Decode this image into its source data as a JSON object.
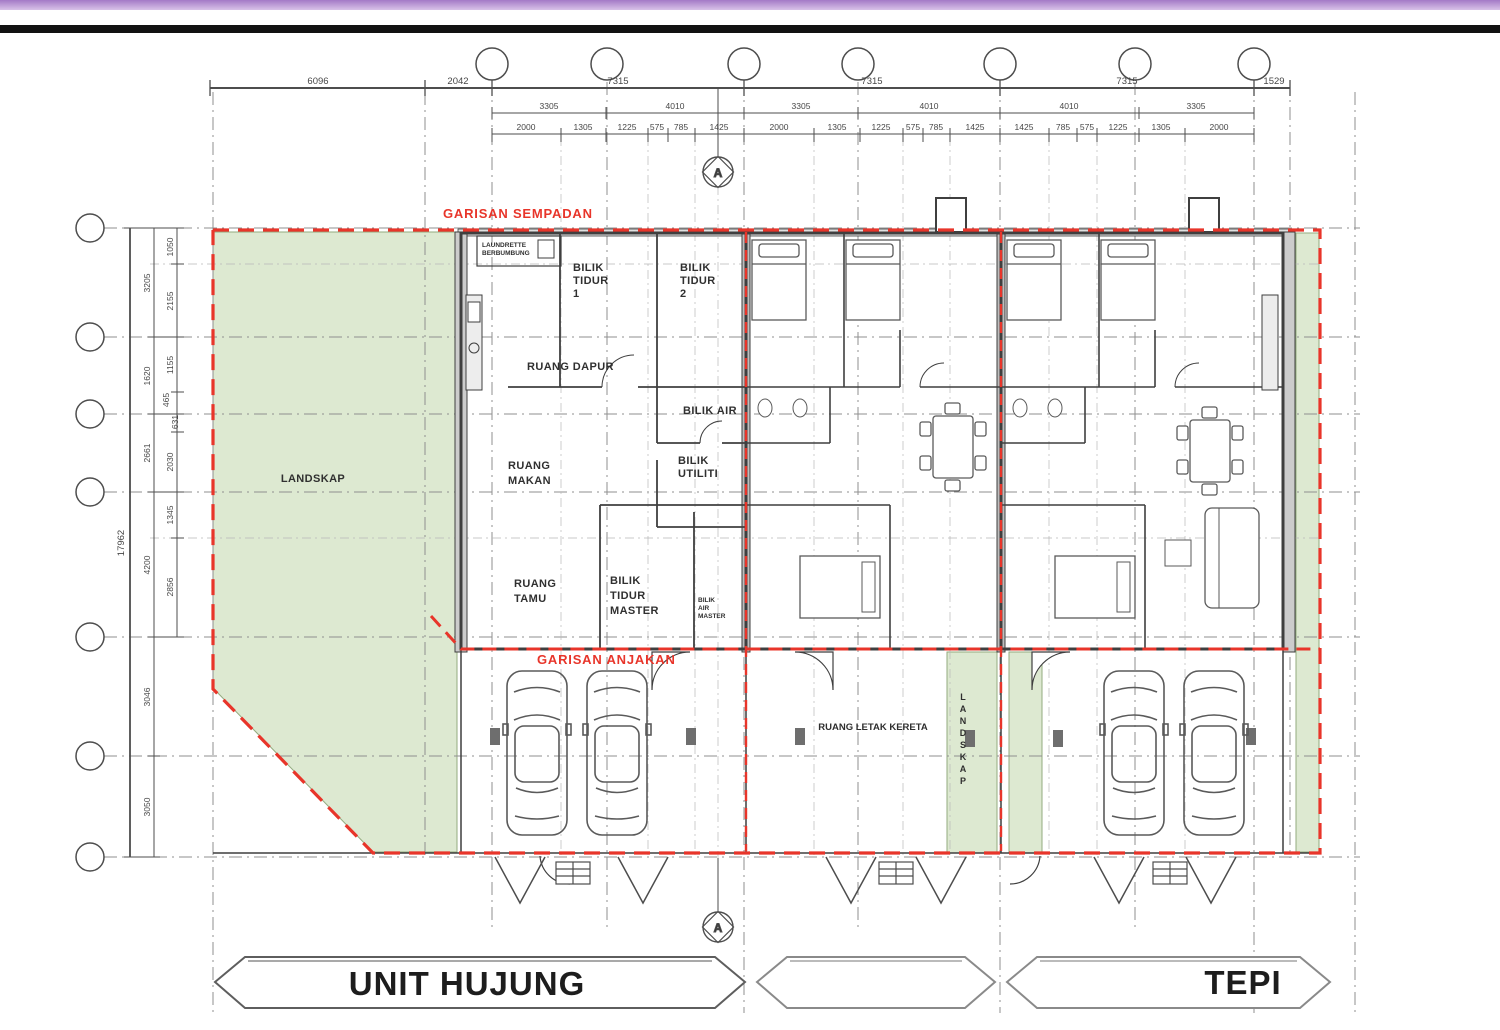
{
  "colors": {
    "topbar": "#b491d2",
    "rule": "#121212",
    "red": "#e8352a",
    "green_fill": "#dde9d1",
    "green_edge": "#93ab7f",
    "wall": "#3f3f3f",
    "grid": "#8f8f8f"
  },
  "dims": {
    "top_row1": [
      "6096",
      "2042",
      "7315",
      "7315",
      "7315",
      "1529"
    ],
    "top_row2": [
      "3305",
      "4010",
      "3305",
      "4010",
      "4010",
      "3305"
    ],
    "top_row3_u1": [
      "2000",
      "1305",
      "1225",
      "575",
      "785",
      "1425"
    ],
    "top_row3_u2": [
      "2000",
      "1305",
      "1225",
      "575",
      "785",
      "1425"
    ],
    "top_row3_u3": [
      "1425",
      "785",
      "575",
      "1225",
      "1305",
      "2000"
    ],
    "left_total": "17962",
    "left_mid": [
      "3205",
      "1620",
      "2661",
      "4200",
      "3046",
      "3050"
    ],
    "left_inner": [
      "1050",
      "2155",
      "1155",
      "465",
      "631",
      "2030",
      "1345",
      "2856"
    ]
  },
  "labels": {
    "boundary": "GARISAN SEMPADAN",
    "setback": "GARISAN ANJAKAN",
    "landscape": "LANDSKAP",
    "landscape_vertical": "LANDSKAP",
    "carport": "RUANG LETAK KERETA",
    "laundrette": [
      "LAUNDRETTE",
      "BERBUMBUNG"
    ],
    "section_marker": "A"
  },
  "rooms": {
    "bedroom1": [
      "BILIK",
      "TIDUR",
      "1"
    ],
    "bedroom2": [
      "BILIK",
      "TIDUR",
      "2"
    ],
    "kitchen": "RUANG DAPUR",
    "bathroom": "BILIK AIR",
    "utility": [
      "BILIK",
      "UTILITI"
    ],
    "dining": [
      "RUANG",
      "MAKAN"
    ],
    "living": [
      "RUANG",
      "TAMU"
    ],
    "master_bedroom": [
      "BILIK",
      "TIDUR",
      "MASTER"
    ],
    "master_bath": [
      "BILIK",
      "AIR",
      "MASTER"
    ]
  },
  "banners": {
    "end_unit": "UNIT HUJUNG",
    "middle": "",
    "side": "TEPI"
  }
}
